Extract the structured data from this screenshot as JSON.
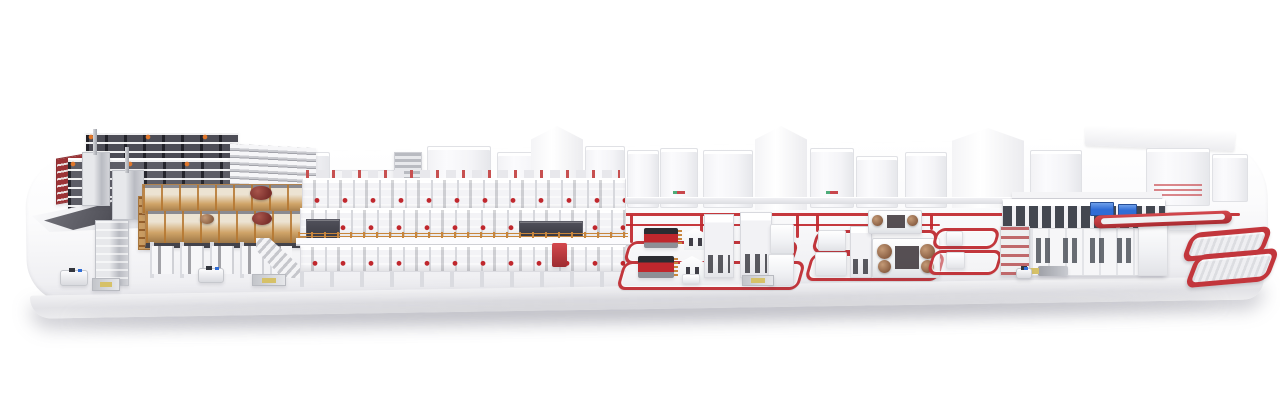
{
  "meta": {
    "description": "3D rendered overview of a complete corrugated-board production plant displayed on a white rounded podium; no visible text labels in the image"
  },
  "colors": {
    "accent_red": "#c0272d",
    "loop_red": "#c2363c",
    "dark_red": "#9c3336",
    "roll_maroon": "#7a2f2b",
    "roll_brown": "#a97a55",
    "frame_orange": "#c8863c",
    "wood_tan": "#cfa367",
    "rack_dark": "#4d4d56",
    "panel_dark": "#3a3a42",
    "metal": "#b9bbc2",
    "machine_white": "#f5f5f7",
    "screen_blue": "#2f6cd5",
    "pallet_yellow": "#d6c168",
    "platform_front": "#e2e2e6"
  },
  "components": {
    "platform": [
      "white-podium-top",
      "podium-front-edge",
      "floor-shadow"
    ],
    "roll_storage": [
      "red-storage-rack",
      "reel-rack-back-row",
      "reel-rack-front-row",
      "white-shelf-stack",
      "handling-deck",
      "dark-ramp",
      "splicer-tower-a",
      "splicer-tower-b",
      "elevator-tower",
      "agv-shuttle",
      "pallet-station"
    ],
    "wet_end": [
      "wood-mezzanine-upper",
      "wood-mezzanine-lower",
      "orange-shelf-rack",
      "paper-roll-1",
      "paper-roll-2",
      "paper-roll-3",
      "support-columns",
      "under-cabinets",
      "staircase"
    ],
    "corrugator": [
      "roll-stand-top-line",
      "back-module-row",
      "mezzanine-module-row",
      "dark-panel-left",
      "dark-panel-right",
      "orange-railing",
      "mezzanine-floor",
      "front-module-row",
      "support-column-row",
      "red-end-cabinet"
    ],
    "background_buildings": [
      "wall-with-windows",
      "louver-panel",
      "white-cabinets",
      "gabled-halls",
      "sloped-hall-roof"
    ],
    "conveyors": [
      "main-red-floor-line",
      "secondary-red-line",
      "takeoff-walkway",
      "cell-riser-lines"
    ],
    "converting_cell_1": [
      "floor-loop-a",
      "floor-loop-b",
      "flexo-printer-1",
      "flexo-printer-2",
      "house-unit-1",
      "house-unit-2",
      "white-tower-1",
      "white-tower-2",
      "right-unit-1",
      "right-unit-2",
      "pallet-load",
      "small-box"
    ],
    "converting_cell_2": [
      "floor-loop-a",
      "floor-loop-b",
      "die-cutter-small",
      "die-cutter-large",
      "tooling-rolls",
      "small-unit-a",
      "small-unit-b",
      "mid-tower"
    ],
    "mid_loops": [
      "transfer-loop-1",
      "transfer-loop-2",
      "buffer-box-1",
      "buffer-box-2"
    ],
    "logistics_center": [
      "roof-canopy",
      "upper-window-band",
      "display-screen-1",
      "display-screen-2",
      "lower-panel-band",
      "shelf-annex-left",
      "tower-annex-right",
      "gate-unit",
      "forklift",
      "mini-agv"
    ],
    "outfeed": [
      "long-red-conveyor-bar",
      "racetrack-loop-1",
      "racetrack-loop-2"
    ]
  }
}
